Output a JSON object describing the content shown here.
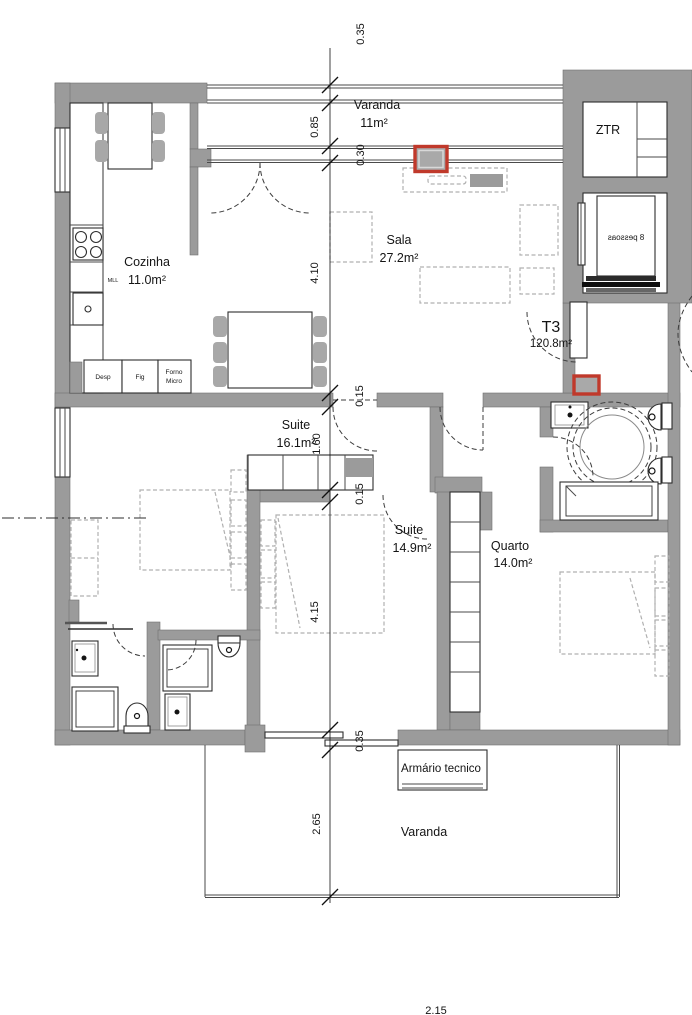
{
  "floorplan": {
    "unit": {
      "code": "T3",
      "area": "120.8m²"
    },
    "rooms": {
      "varanda_top": {
        "name": "Varanda",
        "area": "11m²"
      },
      "cozinha": {
        "name": "Cozinha",
        "area": "11.0m²"
      },
      "sala": {
        "name": "Sala",
        "area": "27.2m²"
      },
      "ztr": {
        "name": "ZTR"
      },
      "suite1": {
        "name": "Suite",
        "area": "16.1m²"
      },
      "suite2": {
        "name": "Suite",
        "area": "14.9m²"
      },
      "quarto": {
        "name": "Quarto",
        "area": "14.0m²"
      },
      "armario": {
        "name": "Armário tecnico"
      },
      "varanda_bottom": {
        "name": "Varanda"
      }
    },
    "elevator": {
      "capacity": "8 pessoas"
    },
    "kitchen": {
      "mll": "MLL",
      "desp": "Desp",
      "fig": "Fig",
      "forno": "Forno",
      "micro": "Micro"
    },
    "dimensions": {
      "top_035": "0.35",
      "top_085": "0.85",
      "top_030": "0.30",
      "sala_410": "4.10",
      "wall_015a": "0.15",
      "hall_160": "1.60",
      "wall_015b": "0.15",
      "rooms_415": "4.15",
      "bottom_035": "0.35",
      "balcony_265": "2.65",
      "bottom_215": "2.15"
    },
    "colors": {
      "wall": "#9b9b9b",
      "line": "#4a4a4a",
      "furniture": "#b0b0b0",
      "highlight": "#c0392b",
      "text": "#141414",
      "background": "#ffffff"
    }
  }
}
